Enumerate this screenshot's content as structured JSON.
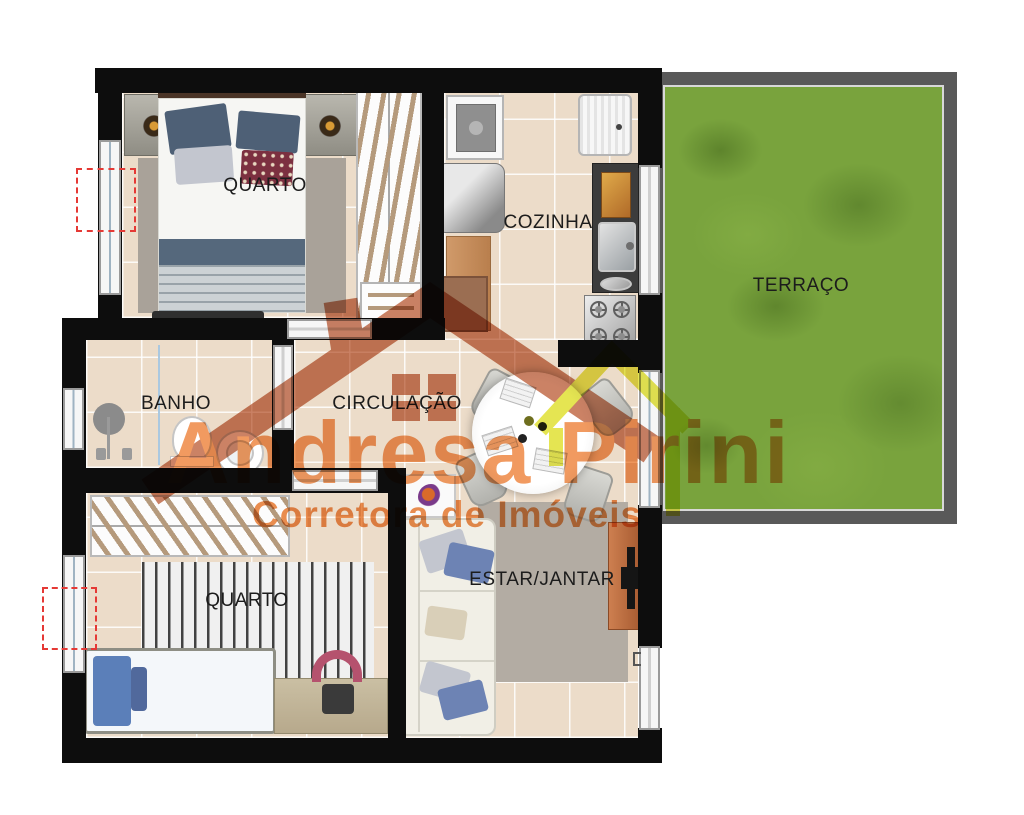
{
  "rooms": {
    "quarto1": {
      "label": "QUARTO"
    },
    "cozinha": {
      "label": "COZINHA"
    },
    "terraco": {
      "label": "TERRAÇO"
    },
    "banho": {
      "label": "BANHO"
    },
    "circulacao": {
      "label": "CIRCULAÇÃO"
    },
    "estar_jantar": {
      "label": "ESTAR/JANTAR"
    },
    "quarto2": {
      "label": "QUARTO"
    }
  },
  "watermark": {
    "brand": "Andresa Pirini",
    "tagline": "Corretora de Imóveis"
  },
  "colors": {
    "wall": "#0d0d0d",
    "floor_tile": "#ecdcc9",
    "grass": "#79a33d",
    "terrace_frame": "#595959",
    "watermark_orange": "#ef8c4a",
    "watermark_salmon": "#c4714f",
    "watermark_yellow": "#e2e23a",
    "door_swing_red": "#e53935"
  }
}
